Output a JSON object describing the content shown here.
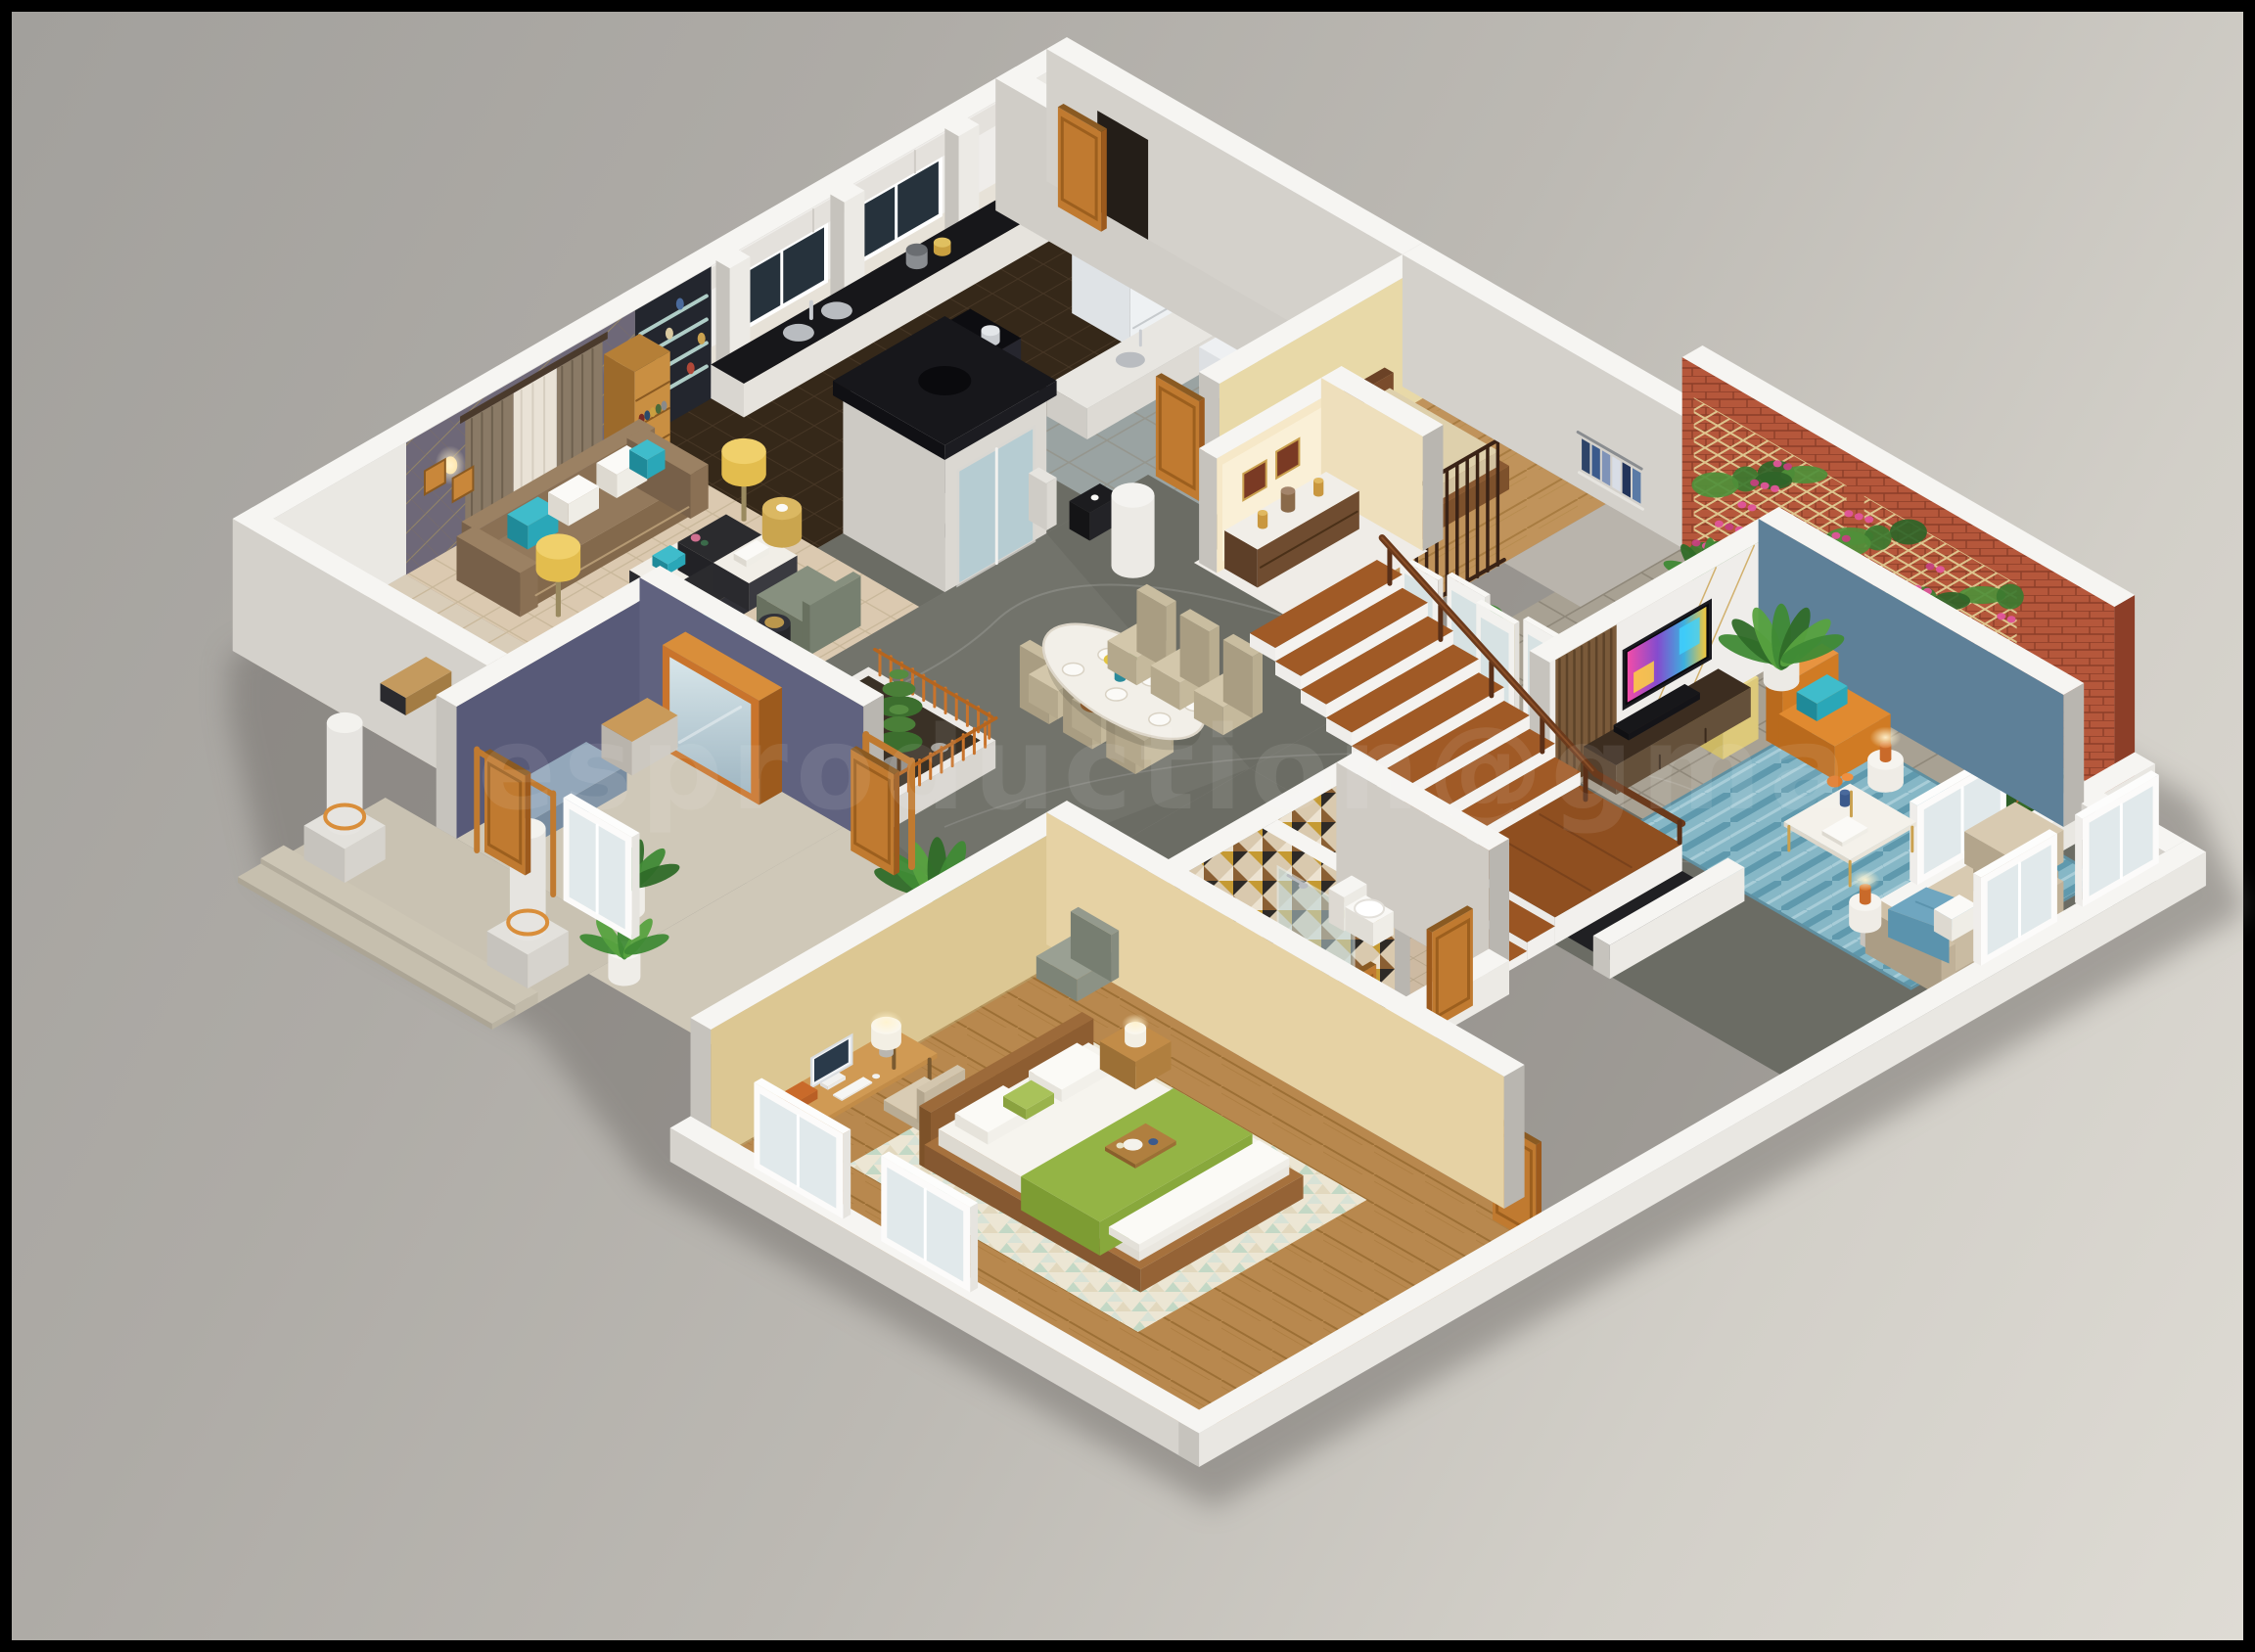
{
  "meta": {
    "title": "3D isometric floor plan render of a residence ground floor"
  },
  "watermark": {
    "text": "esproduction@gma",
    "color": "#ffffff",
    "opacity": "0.085"
  },
  "palette": {
    "frame": "#000000",
    "bgTop": "#a2a09c",
    "bgBottom": "#dedbd4",
    "wallTop": "#f6f5f2",
    "wallLight": "#eceae5",
    "wallMid": "#c6c3bd",
    "wallDark": "#b9b6b0",
    "wallpaper": "#6e6878",
    "navy": "#585a78",
    "blueWall": "#5e8098",
    "brick": "#b5573b",
    "trellis": "#e0cb92",
    "floorLiving": "#dbc9b0",
    "floorHall": "#6b6c64",
    "floorKitchen": "#352819",
    "floorWood": "#b8884e",
    "floorWoodGuest": "#c0935b",
    "pavers": "#a8a193",
    "tileBath": "#cdbaa2",
    "beigeStone": "#cfc8b8",
    "sofaBronze": "#8a7054",
    "teal": "#2aa7b8",
    "orange": "#d9822b",
    "door": "#c07a30",
    "gold": "#caa14f",
    "lampYellow": "#e3bd4e",
    "bedGreen": "#94b445",
    "tanWall": "#dcc793",
    "cream": "#f6e8c8",
    "rugBlue": "#86b7c6",
    "plantGreen": "#3f8a35",
    "pinkFlower": "#e0559a",
    "tvDark": "#08080c"
  },
  "rooms": [
    {
      "id": "living-room",
      "contents": [
        "bronze leather sofa",
        "teal and white pillows",
        "quad marble-and-mesh coffee table",
        "two sage armchairs",
        "gold drum lamps",
        "wall sconces",
        "brown and cream curtains",
        "wood bookcase",
        "gold-line wallpaper"
      ]
    },
    {
      "id": "kitchen",
      "contents": [
        "white cabinets",
        "twin windows",
        "black counter with double sink",
        "black island with cooktop",
        "white refrigerator"
      ]
    },
    {
      "id": "pantry-shelving",
      "contents": [
        "dark wall",
        "glass shelves",
        "bottle rack"
      ]
    },
    {
      "id": "elevator",
      "contents": [
        "black canopy",
        "glass door"
      ]
    },
    {
      "id": "utility-area",
      "contents": [
        "second sink",
        "washer",
        "black floor lamp"
      ]
    },
    {
      "id": "guest-bedroom",
      "contents": [
        "single bed",
        "white pillow",
        "wood slat screen",
        "open closet with blue clothes"
      ]
    },
    {
      "id": "courtyard-garden",
      "contents": [
        "red brick wall",
        "wood lattice trellis",
        "pink climbing flowers",
        "potted plants",
        "stone pavers",
        "pedestal planters"
      ]
    },
    {
      "id": "dining-area",
      "contents": [
        "oval marble table",
        "six beige chairs",
        "place settings",
        "flower centerpiece"
      ]
    },
    {
      "id": "shrine-niche",
      "contents": [
        "cream alcove",
        "wood cabinet",
        "framed pictures",
        "brass lamps"
      ]
    },
    {
      "id": "family-lounge",
      "contents": [
        "blue accent wall",
        "wall tv",
        "media console",
        "blue striped rug",
        "beige sofa with blue throw",
        "orange leather armchair",
        "white coffee table",
        "orange table lamps",
        "palm plant"
      ]
    },
    {
      "id": "staircase",
      "contents": [
        "l-shaped wood stairs",
        "landing",
        "dark wood handrail",
        "stair void"
      ]
    },
    {
      "id": "foyer",
      "contents": [
        "navy walls",
        "orange framed mirror",
        "stone bench",
        "banana plants",
        "entry steps",
        "white columns"
      ]
    },
    {
      "id": "bathrooms",
      "contents": [
        "geometric mosaic walls",
        "wood vanity with oval sink",
        "glass shower",
        "toilet",
        "orange doors"
      ]
    },
    {
      "id": "master-bedroom",
      "contents": [
        "desk with computer and lamp",
        "swivel chair",
        "bed with green runner and breakfast tray",
        "triangle pattern rug",
        "wood floor",
        "tan walls",
        "nightstand lamp"
      ]
    },
    {
      "id": "zen-planter",
      "contents": [
        "raised planter",
        "pine bonsai",
        "orange picket fence"
      ]
    }
  ]
}
